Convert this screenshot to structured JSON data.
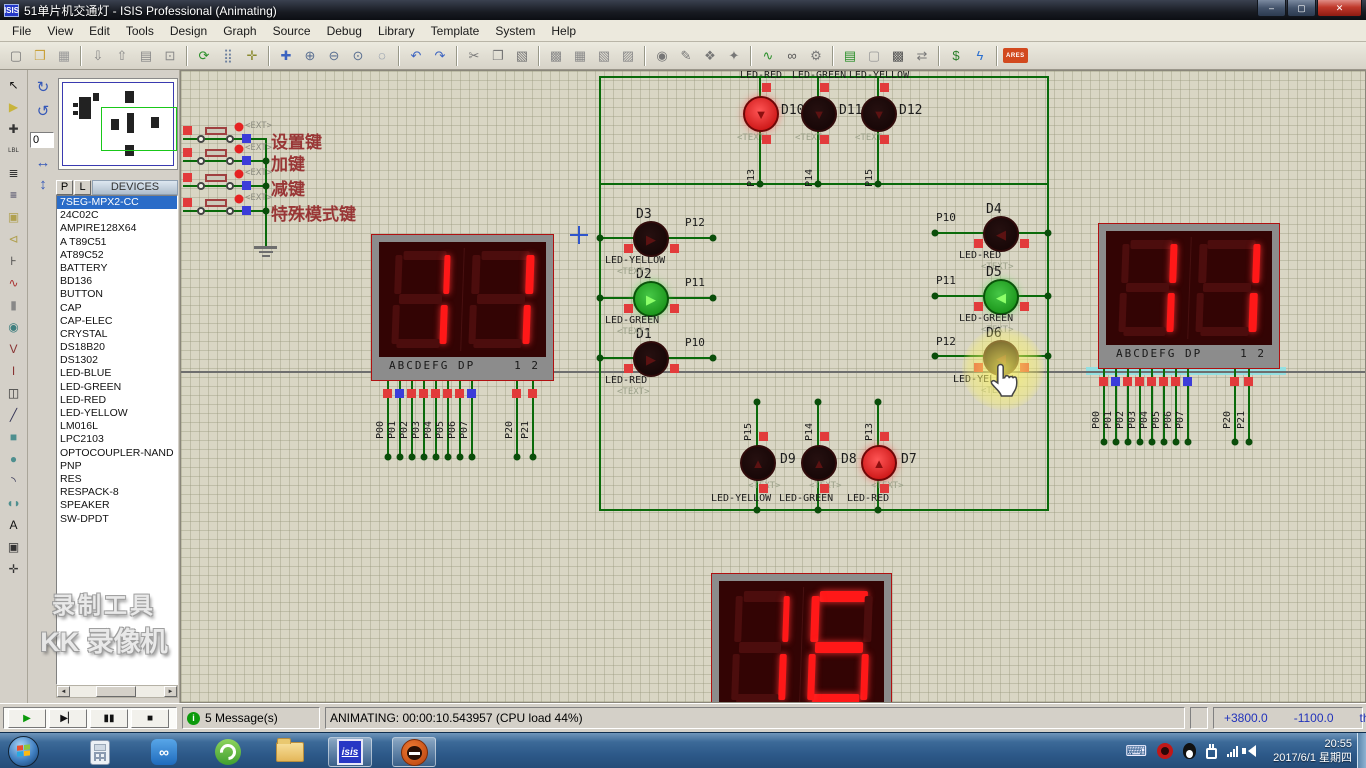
{
  "window": {
    "title": "51单片机交通灯 - ISIS Professional (Animating)",
    "app_badge": "ISIS",
    "min": "–",
    "max": "▢",
    "close": "✕"
  },
  "menu": [
    "File",
    "View",
    "Edit",
    "Tools",
    "Design",
    "Graph",
    "Source",
    "Debug",
    "Library",
    "Template",
    "System",
    "Help"
  ],
  "toolbar_groups": [
    [
      {
        "n": "new-file-icon",
        "g": "▢",
        "c": "#777"
      },
      {
        "n": "open-file-icon",
        "g": "❒",
        "c": "#c9a13b"
      },
      {
        "n": "save-file-icon",
        "g": "▦",
        "c": "#999"
      }
    ],
    [
      {
        "n": "import-icon",
        "g": "⇩",
        "c": "#888"
      },
      {
        "n": "export-icon",
        "g": "⇧",
        "c": "#888"
      },
      {
        "n": "print-icon",
        "g": "▤",
        "c": "#888"
      },
      {
        "n": "mark-area-icon",
        "g": "⊡",
        "c": "#888"
      }
    ],
    [
      {
        "n": "redraw-icon",
        "g": "⟳",
        "c": "#2a8f2a"
      },
      {
        "n": "grid-icon",
        "g": "⣿",
        "c": "#6b7f9e"
      },
      {
        "n": "origin-icon",
        "g": "✛",
        "c": "#8a8a2f"
      }
    ],
    [
      {
        "n": "pan-icon",
        "g": "✚",
        "c": "#3b63c0"
      },
      {
        "n": "zoom-in-icon",
        "g": "⊕",
        "c": "#5a6f91"
      },
      {
        "n": "zoom-out-icon",
        "g": "⊖",
        "c": "#5a6f91"
      },
      {
        "n": "zoom-all-icon",
        "g": "⊙",
        "c": "#5a6f91"
      },
      {
        "n": "zoom-area-icon",
        "g": "◌",
        "c": "#5a6f91"
      }
    ],
    [
      {
        "n": "undo-icon",
        "g": "↶",
        "c": "#3b63c0"
      },
      {
        "n": "redo-icon",
        "g": "↷",
        "c": "#3b63c0"
      }
    ],
    [
      {
        "n": "cut-icon",
        "g": "✂",
        "c": "#777"
      },
      {
        "n": "copy-icon",
        "g": "❐",
        "c": "#777"
      },
      {
        "n": "paste-icon",
        "g": "▧",
        "c": "#777"
      }
    ],
    [
      {
        "n": "block-copy-icon",
        "g": "▩",
        "c": "#8a8a8a"
      },
      {
        "n": "block-move-icon",
        "g": "▦",
        "c": "#8a8a8a"
      },
      {
        "n": "block-rotate-icon",
        "g": "▧",
        "c": "#8a8a8a"
      },
      {
        "n": "block-delete-icon",
        "g": "▨",
        "c": "#8a8a8a"
      }
    ],
    [
      {
        "n": "pick-device-icon",
        "g": "◉",
        "c": "#777"
      },
      {
        "n": "make-device-icon",
        "g": "✎",
        "c": "#777"
      },
      {
        "n": "packaging-icon",
        "g": "❖",
        "c": "#777"
      },
      {
        "n": "decompose-icon",
        "g": "✦",
        "c": "#777"
      }
    ],
    [
      {
        "n": "wire-autorouter-icon",
        "g": "∿",
        "c": "#2a8f2a"
      },
      {
        "n": "search-tag-icon",
        "g": "∞",
        "c": "#555"
      },
      {
        "n": "property-assign-icon",
        "g": "⚙",
        "c": "#777"
      }
    ],
    [
      {
        "n": "design-explorer-icon",
        "g": "▤",
        "c": "#2a8f2a"
      },
      {
        "n": "new-sheet-icon",
        "g": "▢",
        "c": "#999"
      },
      {
        "n": "remove-sheet-icon",
        "g": "▩",
        "c": "#555"
      },
      {
        "n": "goto-sheet-icon",
        "g": "⇄",
        "c": "#777"
      }
    ],
    [
      {
        "n": "bill-of-materials-icon",
        "g": "$",
        "c": "#2a7f2a"
      },
      {
        "n": "electrical-check-icon",
        "g": "ϟ",
        "c": "#2a6fd0"
      }
    ],
    [
      {
        "n": "netlist-to-ares-icon",
        "g": "ARES",
        "c": "#fff",
        "bg": "#d2491e"
      }
    ]
  ],
  "mode_toolbar": [
    {
      "n": "selection-mode-icon",
      "g": "↖",
      "c": "#111"
    },
    {
      "n": "component-mode-icon",
      "g": "▶",
      "c": "#c8b43c"
    },
    {
      "n": "junction-dot-icon",
      "g": "✚",
      "c": "#333"
    },
    {
      "n": "wire-label-icon",
      "g": "LBL",
      "c": "#333"
    },
    {
      "n": "text-script-icon",
      "g": "≣",
      "c": "#333"
    },
    {
      "n": "bus-icon",
      "g": "≡",
      "c": "#335"
    },
    {
      "n": "subcircuit-icon",
      "g": "▣",
      "c": "#b0a050"
    },
    {
      "n": "terminal-icon",
      "g": "⊲",
      "c": "#b0a050"
    },
    {
      "n": "device-pin-icon",
      "g": "⊦",
      "c": "#333"
    },
    {
      "n": "graph-mode-icon",
      "g": "∿",
      "c": "#a33"
    },
    {
      "n": "tape-recorder-icon",
      "g": "▮",
      "c": "#888"
    },
    {
      "n": "generator-mode-icon",
      "g": "◉",
      "c": "#3f7f7f"
    },
    {
      "n": "voltage-probe-icon",
      "g": "V",
      "c": "#883333"
    },
    {
      "n": "current-probe-icon",
      "g": "I",
      "c": "#883333"
    },
    {
      "n": "instrument-icon",
      "g": "◫",
      "c": "#333"
    },
    {
      "n": "2d-line-icon",
      "g": "╱",
      "c": "#335"
    },
    {
      "n": "2d-box-icon",
      "g": "■",
      "c": "#4e8f8f"
    },
    {
      "n": "2d-circle-icon",
      "g": "●",
      "c": "#4e8f8f"
    },
    {
      "n": "2d-arc-icon",
      "g": "◝",
      "c": "#335"
    },
    {
      "n": "2d-path-icon",
      "g": "◖◗",
      "c": "#4e8f8f"
    },
    {
      "n": "2d-text-icon",
      "g": "A",
      "c": "#111"
    },
    {
      "n": "2d-symbol-icon",
      "g": "▣",
      "c": "#333"
    },
    {
      "n": "2d-marker-icon",
      "g": "✛",
      "c": "#333"
    }
  ],
  "rotate": {
    "cw": "↻",
    "ccw": "↺",
    "angle": "0",
    "hmirror": "↔",
    "vmirror": "↕"
  },
  "object_selector": {
    "p": "P",
    "l": "L",
    "header": "DEVICES",
    "selected": "7SEG-MPX2-CC",
    "devices": [
      "7SEG-MPX2-CC",
      "24C02C",
      "AMPIRE128X64",
      "A T89C51",
      "AT89C52",
      "BATTERY",
      "BD136",
      "BUTTON",
      "CAP",
      "CAP-ELEC",
      "CRYSTAL",
      "DS18B20",
      "DS1302",
      "LED-BLUE",
      "LED-GREEN",
      "LED-RED",
      "LED-YELLOW",
      "LM016L",
      "LPC2103",
      "OPTOCOUPLER-NAND",
      "PNP",
      "RES",
      "RESPACK-8",
      "SPEAKER",
      "SW-DPDT"
    ]
  },
  "watermark": {
    "line1": "录制工具",
    "line2": "KK 录像机"
  },
  "canvas": {
    "keys": [
      {
        "label": "设置键",
        "ext": "<EXT>"
      },
      {
        "label": "加键",
        "ext": "<EXT>"
      },
      {
        "label": "减键",
        "ext": "<EXT>"
      },
      {
        "label": "特殊模式键",
        "ext": "<EXT>"
      }
    ],
    "leds": [
      {
        "id": "D1",
        "type": "LED-RED",
        "pin": "P10",
        "state": "off"
      },
      {
        "id": "D2",
        "type": "LED-GREEN",
        "pin": "P11",
        "state": "green"
      },
      {
        "id": "D3",
        "type": "LED-YELLOW",
        "pin": "P12",
        "state": "off"
      },
      {
        "id": "D4",
        "type": "LED-RED",
        "pin": "P10",
        "state": "off"
      },
      {
        "id": "D5",
        "type": "LED-GREEN",
        "pin": "P11",
        "state": "green"
      },
      {
        "id": "D6",
        "type": "LED-YELLOW",
        "pin": "P12",
        "state": "off"
      },
      {
        "id": "D7",
        "type": "LED-RED",
        "pin": "P13",
        "state": "red"
      },
      {
        "id": "D8",
        "type": "LED-GREEN",
        "pin": "P14",
        "state": "off"
      },
      {
        "id": "D9",
        "type": "LED-YELLOW",
        "pin": "P15",
        "state": "off"
      },
      {
        "id": "D10",
        "type": "LED-RED",
        "pin": "P13",
        "state": "red"
      },
      {
        "id": "D11",
        "type": "LED-GREEN",
        "pin": "P14",
        "state": "off"
      },
      {
        "id": "D12",
        "type": "LED-YELLOW",
        "pin": "P15",
        "state": "off"
      }
    ],
    "text_tag": "<TEXT>",
    "displays": [
      {
        "name": "left",
        "value": "11"
      },
      {
        "name": "right",
        "value": "11"
      },
      {
        "name": "bottom",
        "value": "16"
      }
    ],
    "seg_pins_left": "ABCDEFG  DP",
    "seg_pins_right": "1 2",
    "pin_labels_main": [
      "P00",
      "P01",
      "P02",
      "P03",
      "P04",
      "P05",
      "P06",
      "P07"
    ],
    "pin_states_main": [
      "r",
      "b",
      "r",
      "r",
      "r",
      "r",
      "r",
      "b"
    ],
    "pin_labels_com": [
      "P20",
      "P21"
    ],
    "pin_states_com": [
      "r",
      "r"
    ]
  },
  "playback": [
    {
      "n": "play-button",
      "g": "▶",
      "c": "#0b9a0b"
    },
    {
      "n": "step-button",
      "g": "▶▏",
      "c": "#111"
    },
    {
      "n": "pause-button",
      "g": "▮▮",
      "c": "#111"
    },
    {
      "n": "stop-button",
      "g": "■",
      "c": "#111"
    }
  ],
  "status": {
    "messages": "5 Message(s)",
    "animating": "ANIMATING: 00:00:10.543957 (CPU load 44%)",
    "coord_x": "+3800.0",
    "coord_y": "-1100.0",
    "units": "th"
  },
  "taskbar": {
    "isis_label": "isis",
    "time": "20:55",
    "date": "2017/6/1 星期四"
  }
}
